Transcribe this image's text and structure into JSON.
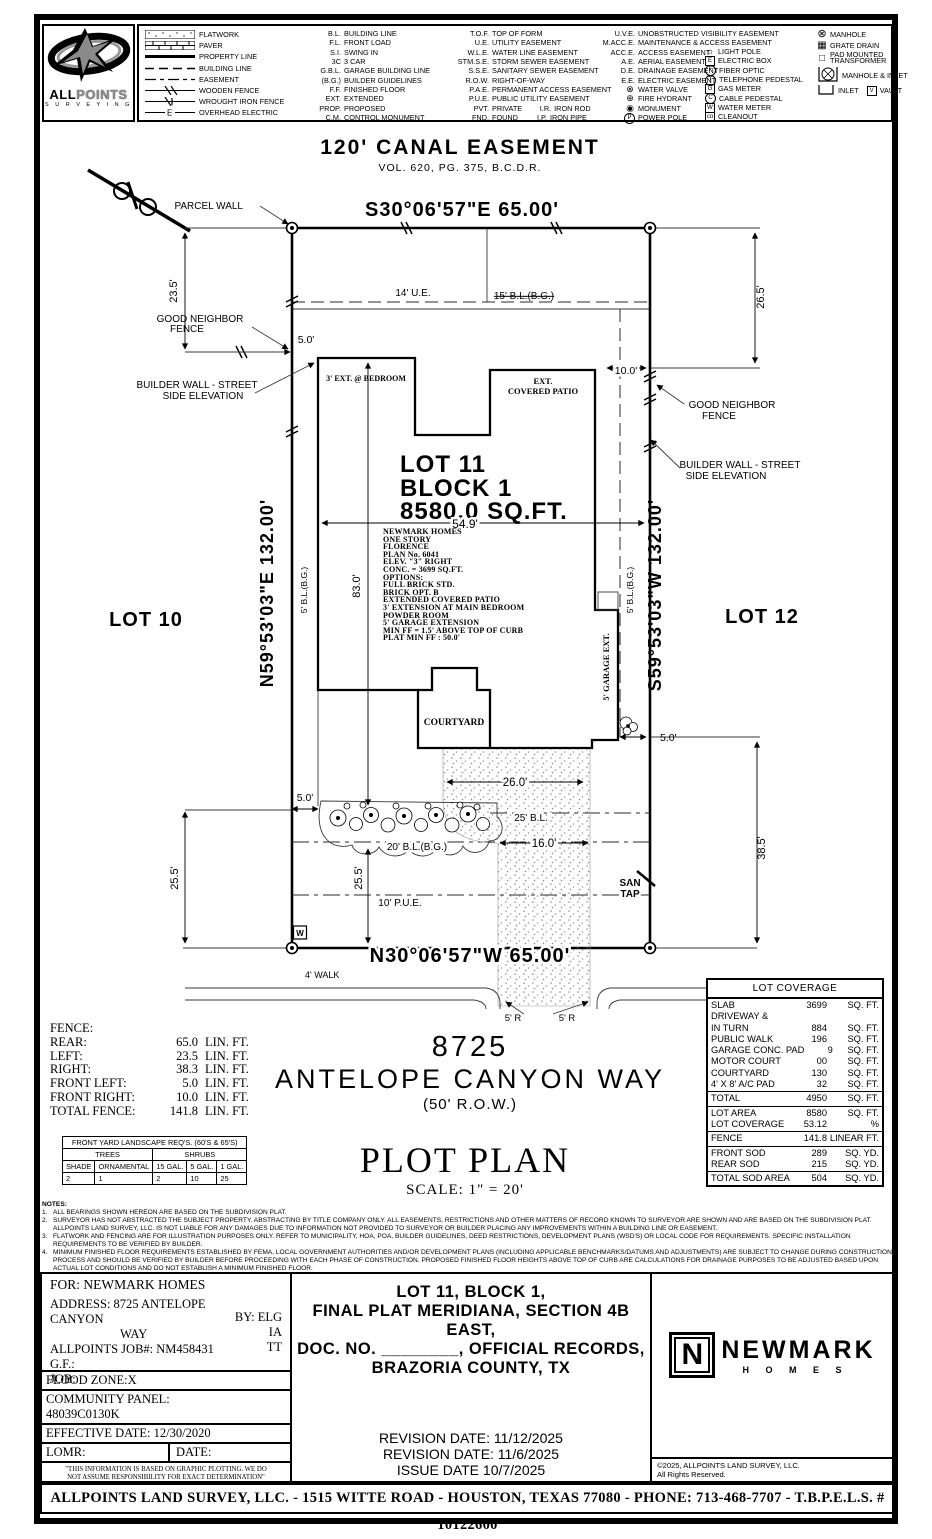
{
  "logo": {
    "brand_all": "ALL",
    "brand_points": "POINTS",
    "brand_sub": "S U R V E Y I N G"
  },
  "legend": {
    "lines": [
      {
        "label": "FLATWORK"
      },
      {
        "label": "PAVER"
      },
      {
        "label": "PROPERTY LINE"
      },
      {
        "label": "BUILDING LINE"
      },
      {
        "label": "EASEMENT"
      },
      {
        "label": "WOODEN FENCE"
      },
      {
        "label": "WROUGHT IRON FENCE"
      },
      {
        "label": "OVERHEAD ELECTRIC"
      }
    ],
    "col1": [
      {
        "abbr": "B.L.",
        "label": "BUILDING LINE"
      },
      {
        "abbr": "F.L.",
        "label": "FRONT LOAD"
      },
      {
        "abbr": "S.I.",
        "label": "SWING IN"
      },
      {
        "abbr": "3C",
        "label": "3 CAR"
      },
      {
        "abbr": "G.B.L.",
        "label": "GARAGE BUILDING LINE"
      },
      {
        "abbr": "(B.G.)",
        "label": "BUILDER GUIDELINES"
      },
      {
        "abbr": "F.F.",
        "label": "FINISHED FLOOR"
      },
      {
        "abbr": "EXT.",
        "label": "EXTENDED"
      },
      {
        "abbr": "PROP.",
        "label": "PROPOSED"
      },
      {
        "abbr": "C.M.",
        "label": "CONTROL MONUMENT"
      }
    ],
    "col2": [
      {
        "abbr": "T.O.F.",
        "label": "TOP OF FORM",
        "abbr2": "",
        "label2": ""
      },
      {
        "abbr": "U.E.",
        "label": "UTILITY EASEMENT",
        "abbr2": "",
        "label2": ""
      },
      {
        "abbr": "W.L.E.",
        "label": "WATER LINE EASEMENT",
        "abbr2": "",
        "label2": ""
      },
      {
        "abbr": "STM.S.E.",
        "label": "STORM SEWER EASEMENT",
        "abbr2": "",
        "label2": ""
      },
      {
        "abbr": "S.S.E.",
        "label": "SANITARY SEWER EASEMENT",
        "abbr2": "",
        "label2": ""
      },
      {
        "abbr": "R.O.W.",
        "label": "RIGHT-OF-WAY",
        "abbr2": "",
        "label2": ""
      },
      {
        "abbr": "P.A.E.",
        "label": "PERMANENT ACCESS EASEMENT",
        "abbr2": "",
        "label2": ""
      },
      {
        "abbr": "P.U.E.",
        "label": "PUBLIC UTILITY EASEMENT",
        "abbr2": "",
        "label2": ""
      },
      {
        "abbr": "PVT.",
        "label": "PRIVATE",
        "abbr2": "I.R.",
        "label2": "IRON ROD"
      },
      {
        "abbr": "FND.",
        "label": "FOUND",
        "abbr2": "I.P.",
        "label2": "IRON PIPE"
      }
    ],
    "col3": [
      {
        "abbr": "U.V.E.",
        "label": "UNOBSTRUCTED VISIBILITY EASEMENT"
      },
      {
        "abbr": "M.ACC.E.",
        "label": "MAINTENANCE & ACCESS EASEMENT"
      },
      {
        "abbr": "ACC.E.",
        "label": "ACCESS EASEMENT"
      },
      {
        "abbr": "A.E.",
        "label": "AERIAL EASEMENT"
      },
      {
        "abbr": "D.E.",
        "label": "DRAINAGE EASEMENT"
      },
      {
        "abbr": "E.E.",
        "label": "ELECTRIC EASEMENT"
      }
    ],
    "col3_symbols": [
      {
        "glyph": "⊗",
        "label": "WATER VALVE"
      },
      {
        "glyph": "⊕",
        "label": "FIRE HYDRANT"
      },
      {
        "glyph": "◉",
        "label": "MONUMENT"
      },
      {
        "glyph": "P",
        "label": "POWER POLE"
      }
    ],
    "col4_symbols": [
      {
        "glyph": "☼",
        "label": "LIGHT POLE"
      },
      {
        "glyph": "E",
        "label": "ELECTRIC BOX"
      },
      {
        "glyph": "F",
        "label": "FIBER OPTIC"
      },
      {
        "glyph": "T",
        "label": "TELEPHONE PEDESTAL"
      },
      {
        "glyph": "G",
        "label": "GAS METER"
      },
      {
        "glyph": "C",
        "label": "CABLE PEDESTAL"
      },
      {
        "glyph": "W",
        "label": "WATER METER"
      },
      {
        "glyph": "co",
        "label": "CLEANOUT"
      }
    ],
    "col5_symbols": [
      {
        "glyph": "⊗",
        "label": "MANHOLE"
      },
      {
        "glyph": "▦",
        "label": "GRATE DRAIN"
      },
      {
        "glyph": "□",
        "label": "PAD MOUNTED TRANSFORMER"
      },
      {
        "glyph": "⊗",
        "label": "MANHOLE & INLET"
      },
      {
        "glyph": "⊔",
        "label": "INLET"
      },
      {
        "glyph": "V",
        "label": "VAULT"
      }
    ]
  },
  "plot": {
    "canal_title": "120' CANAL EASEMENT",
    "canal_vol": "VOL. 620, PG. 375, B.C.D.R.",
    "parcel_wall": "PARCEL WALL",
    "bearing_top": "S30°06'57\"E   65.00'",
    "bearing_bottom": "N30°06'57\"W   65.00'",
    "bearing_left": "N59°53'03\"E   132.00'",
    "bearing_right": "S59°53'03\"W   132.00'",
    "dim_23_5": "23.5'",
    "dim_26_5": "26.5'",
    "ue_14": "14' U.E.",
    "bl_15": "15' B.L.(B.G.)",
    "good_neighbor_1": "GOOD  NEIGHBOR",
    "good_neighbor_2": "FENCE",
    "builder_wall_1": "BUILDER  WALL  - STREET",
    "builder_wall_2": "SIDE  ELEVATION",
    "dim_5_0": "5.0'",
    "dim_10_0": "10.0'",
    "ext_bedroom": "3' EXT. @ BEDROOM",
    "patio_1": "EXT.",
    "patio_2": "COVERED PATIO",
    "lot11": "LOT 11",
    "block1": "BLOCK 1",
    "area": "8580.0 SQ.FT.",
    "dim_54_9": "54.9'",
    "house_desc": [
      "NEWMARK HOMES",
      "ONE STORY",
      "FLORENCE",
      "PLAN No. 6041",
      "ELEV. \"3\" RIGHT",
      "CONC. = 3699 SQ.FT.",
      "OPTIONS:",
      "FULL BRICK STD.",
      "BRICK OPT. B",
      "EXTENDED COVERED PATIO",
      "3' EXTENSION AT MAIN BEDROOM",
      "POWDER ROOM",
      "5' GARAGE EXTENSION",
      "MIN FF = 1.5' ABOVE TOP OF CURB",
      "PLAT MIN FF : 50.0'"
    ],
    "dim_83_0": "83.0'",
    "bl_5bg": "5' B.L.(B.G.)",
    "lot10": "LOT 10",
    "lot12": "LOT 12",
    "garage_ext": "5' GARAGE EXT.",
    "courtyard": "COURTYARD",
    "dim_26_0": "26.0'",
    "bl_25": "25' B.L.",
    "dim_16_0": "16.0'",
    "bl_20": "20' B.L.(B.G.)",
    "dim_25_5": "25.5'",
    "pue_10": "10' P.U.E.",
    "san_1": "SAN",
    "san_2": "TAP",
    "dim_38_5": "38.5'",
    "walk_4": "4' WALK",
    "r5": "5' R",
    "w_meter": "W",
    "addr_num": "8725",
    "addr_street": "ANTELOPE CANYON WAY",
    "addr_row": "(50' R.O.W.)",
    "plot_plan": "PLOT PLAN",
    "scale": "SCALE: 1\" = 20'"
  },
  "fence": {
    "title": "FENCE:",
    "rows": [
      {
        "label": "REAR:",
        "value": "65.0",
        "unit": "LIN. FT."
      },
      {
        "label": "LEFT:",
        "value": "23.5",
        "unit": "LIN. FT."
      },
      {
        "label": "RIGHT:",
        "value": "38.3",
        "unit": "LIN. FT."
      },
      {
        "label": "FRONT LEFT:",
        "value": "5.0",
        "unit": "LIN. FT."
      },
      {
        "label": "FRONT RIGHT:",
        "value": "10.0",
        "unit": "LIN. FT."
      },
      {
        "label": "TOTAL FENCE:",
        "value": "141.8",
        "unit": "LIN. FT."
      }
    ]
  },
  "landscape": {
    "title": "FRONT YARD LANDSCAPE REQ'S. (60'S & 65'S)",
    "group1": "TREES",
    "group2": "SHRUBS",
    "cols": [
      "SHADE",
      "ORNAMENTAL",
      "15 GAL.",
      "5 GAL.",
      "1 GAL."
    ],
    "values": [
      "2",
      "1",
      "2",
      "10",
      "25"
    ]
  },
  "coverage": {
    "title": "LOT COVERAGE",
    "sec1": [
      {
        "l": "SLAB",
        "v": "3699",
        "u": "SQ. FT."
      },
      {
        "l": "DRIVEWAY &",
        "v": "",
        "u": ""
      },
      {
        "l": "IN TURN",
        "v": "884",
        "u": "SQ. FT."
      },
      {
        "l": "PUBLIC WALK",
        "v": "196",
        "u": "SQ. FT."
      },
      {
        "l": "GARAGE CONC. PAD",
        "v": "9",
        "u": "SQ. FT."
      },
      {
        "l": "MOTOR COURT",
        "v": "00",
        "u": "SQ. FT."
      },
      {
        "l": "COURTYARD",
        "v": "130",
        "u": "SQ. FT."
      },
      {
        "l": "4' X 8' A/C PAD",
        "v": "32",
        "u": "SQ. FT."
      }
    ],
    "sec2": [
      {
        "l": "TOTAL",
        "v": "4950",
        "u": "SQ. FT."
      }
    ],
    "sec3": [
      {
        "l": "LOT AREA",
        "v": "8580",
        "u": "SQ. FT."
      },
      {
        "l": "LOT COVERAGE",
        "v": "53.12",
        "u": "%"
      }
    ],
    "sec4": [
      {
        "l": "FENCE",
        "v": "141.8",
        "u": "LINEAR FT."
      }
    ],
    "sec5": [
      {
        "l": "FRONT SOD",
        "v": "289",
        "u": "SQ. YD."
      },
      {
        "l": "REAR SOD",
        "v": "215",
        "u": "SQ. YD."
      }
    ],
    "sec6": [
      {
        "l": "TOTAL SOD AREA",
        "v": "504",
        "u": "SQ. YD."
      }
    ]
  },
  "notes": {
    "title": "NOTES:",
    "items": [
      {
        "n": "1.",
        "t": "ALL BEARINGS SHOWN HEREON ARE BASED ON THE SUBDIVISION PLAT."
      },
      {
        "n": "2.",
        "t": "SURVEYOR HAS NOT ABSTRACTED THE SUBJECT PROPERTY. ABSTRACTING BY TITLE COMPANY ONLY. ALL EASEMENTS, RESTRICTIONS AND OTHER MATTERS OF RECORD KNOWN TO SURVEYOR ARE SHOWN AND ARE BASED ON THE SUBDIVISION PLAT. ALLPOINTS LAND SURVEY, LLC. IS NOT LIABLE FOR ANY DAMAGES DUE TO INFORMATION NOT PROVIDED TO SURVEYOR OR BUILDER PLACING ANY IMPROVEMENTS WITHIN A BUILDING LINE OR EASEMENT."
      },
      {
        "n": "3.",
        "t": "FLATWORK AND FENCING ARE FOR ILLUSTRATION PURPOSES ONLY. REFER TO MUNICIPALITY, HOA, POA, BUILDER GUIDELINES, DEED RESTRICTIONS, DEVELOPMENT PLANS (WSD'S) OR LOCAL CODE FOR REQUIREMENTS. SPECIFIC INSTALLATION REQUIREMENTS TO BE VERIFIED BY BUILDER."
      },
      {
        "n": "4.",
        "t": "MINIMUM FINISHED FLOOR REQUIREMENTS ESTABLISHED BY FEMA, LOCAL GOVERNMENT AUTHORITIES AND/OR DEVELOPMENT PLANS (INCLUDING APPLICABLE BENCHMARKS/DATUMS AND ADJUSTMENTS) ARE SUBJECT TO CHANGE DURING CONSTRUCTION PROCESS AND SHOULD BE VERIFIED BY BUILDER BEFORE PROCEEDING WITH EACH PHASE OF CONSTRUCTION.  PROPOSED FINISHED FLOOR HEIGHTS ABOVE TOP OF CURB ARE CALCULATIONS FOR DRAINAGE PURPOSES TO BE ADJUSTED BASED UPON ACTUAL LOT CONDITIONS AND DO NOT ESTABLISH A MINIMUM FINISHED FLOOR."
      }
    ]
  },
  "title_block": {
    "for_line": "FOR:  NEWMARK HOMES",
    "address_line1": "ADDRESS: 8725 ANTELOPE CANYON",
    "address_line2": "WAY",
    "by": "BY: ELG",
    "job_number": "ALLPOINTS JOB#: NM458431",
    "initials2": "IA",
    "gf": "G.F.:",
    "initials3": "TT",
    "job": "JOB:",
    "flood_zone": "FLOOD ZONE:X",
    "community_panel_label": "COMMUNITY PANEL:",
    "community_panel": "48039C0130K",
    "effective_date": "EFFECTIVE DATE: 12/30/2020",
    "lomr": "LOMR:",
    "date": "DATE:",
    "disclaimer_1": "\"THIS INFORMATION IS BASED ON GRAPHIC PLOTTING.  WE DO",
    "disclaimer_2": "NOT ASSUME RESPONSIBILITY FOR EXACT DETERMINATION\"",
    "legal": [
      "LOT  11,  BLOCK  1,",
      "FINAL  PLAT  MERIDIANA,  SECTION  4B  EAST,",
      "DOC.  NO.  ________,  OFFICIAL  RECORDS,",
      "BRAZORIA  COUNTY,  TX"
    ],
    "revisions": [
      "REVISION  DATE:  11/12/2025",
      "REVISION  DATE:  11/6/2025",
      "ISSUE  DATE  10/7/2025"
    ],
    "newmark_n": "N",
    "newmark_name": "NEWMARK",
    "newmark_homes": "H O M E S",
    "copyright_1": "©2025,  ALLPOINTS  LAND  SURVEY,  LLC.",
    "copyright_2": "All  Rights  Reserved."
  },
  "footer": "ALLPOINTS LAND SURVEY, LLC. - 1515 WITTE ROAD - HOUSTON, TEXAS 77080 - PHONE: 713-468-7707 - T.B.P.E.L.S. # 10122600"
}
